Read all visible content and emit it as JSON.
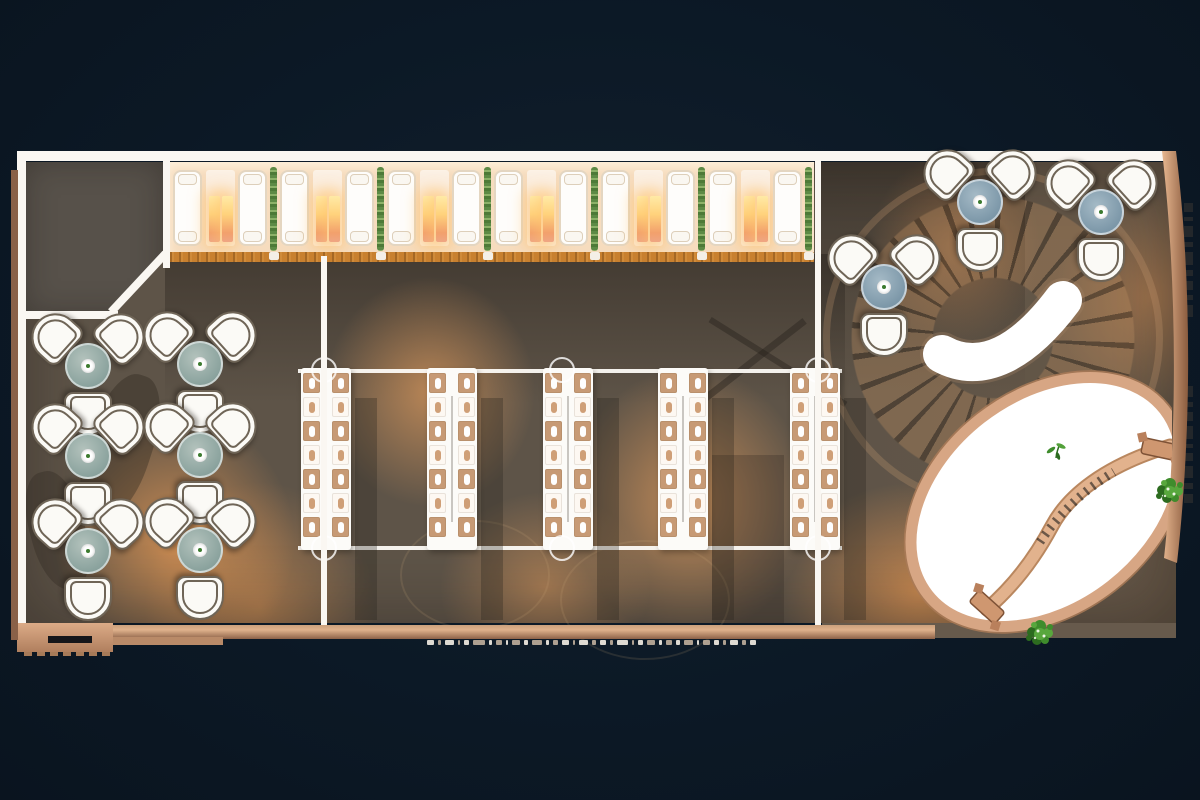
{
  "scene": {
    "title": "restaurant-lounge-floor-plan-top-view",
    "palette": {
      "background_navy": "#0c1926",
      "floor_olive": "#5e5448",
      "warm_light": "#e89854",
      "room_dark": "#57514a",
      "wall_white": "#faf7f2",
      "booth_band": "#f6dcbe",
      "sofa_white": "#fefdfb",
      "lamp_glow": "#ffd27c",
      "plant_green": "#5d8a45",
      "wood_strip": "#c8802f",
      "seat_tan": "#c79a75",
      "seat_cream": "#fdf8f2",
      "cluster_table_left": "#8ba39e",
      "cluster_table_right": "#7d98a9",
      "chair_outline": "#6f6557",
      "stair_copper": "#ba8c60",
      "terrace_white": "#ffffff",
      "copper_rim": "#d7a684",
      "path_copper": "#e2b28d",
      "bush_green": "#3f8c2c",
      "trim_copper": "#caa07c"
    },
    "booth_row": {
      "y": 162,
      "height": 90,
      "module_width": 107,
      "module_starts_x": [
        170,
        277,
        384,
        491,
        598,
        705
      ],
      "sofa1_dx": 3,
      "lamp_dx": 36,
      "sofa2_dx": 68,
      "plant_dx": 100,
      "flame_dx": [
        3,
        16
      ]
    },
    "wood_strip": {
      "x": 170,
      "y": 252,
      "width": 644,
      "notch_dx": 99
    },
    "communal_tables": {
      "tables_x": [
        301,
        427,
        543,
        658,
        790
      ],
      "y": 368,
      "width": 50,
      "height": 182,
      "seats_per_column": 7,
      "columns_dx": [
        2,
        31
      ],
      "seat_pitch": 24,
      "seat_top": 5
    },
    "light_rails": {
      "x": 298,
      "width": 544,
      "rows_y": [
        369,
        546
      ],
      "fixtures_x": [
        324,
        562,
        818
      ],
      "fixture_rows_y": [
        370,
        548
      ]
    },
    "walls": {
      "segments": [
        {
          "name": "wall-top",
          "x": 17,
          "y": 151,
          "w": 1159,
          "h": 10
        },
        {
          "name": "wall-left",
          "x": 17,
          "y": 151,
          "w": 9,
          "h": 474
        },
        {
          "name": "wall-divider-right",
          "x": 815,
          "y": 161,
          "w": 6,
          "h": 465
        },
        {
          "name": "wall-center-line",
          "x": 321,
          "y": 256,
          "w": 6,
          "h": 370
        },
        {
          "name": "wall-room-right",
          "x": 163,
          "y": 161,
          "w": 7,
          "h": 107
        },
        {
          "name": "wall-room-bottom",
          "x": 25,
          "y": 311,
          "w": 93,
          "h": 8
        }
      ],
      "diagonal": {
        "x": 111,
        "y": 308,
        "len": 80,
        "h": 8,
        "angle": -47
      }
    },
    "lounge_clusters": {
      "chairs_per_cluster": 3,
      "left_centers": [
        [
          88,
          372
        ],
        [
          200,
          370
        ],
        [
          88,
          462
        ],
        [
          200,
          461
        ],
        [
          88,
          557
        ],
        [
          200,
          556
        ]
      ],
      "right_centers": [
        [
          884,
          293
        ],
        [
          980,
          208
        ],
        [
          1101,
          218
        ]
      ]
    },
    "staircase": {
      "cx": 993,
      "cy": 338,
      "outer_diameter": 290,
      "landing_crescent_d": "M942,354 C982,376 1024,352 1063,300"
    },
    "terrace": {
      "cx": 1046,
      "cy": 502,
      "rx": 150,
      "ry": 106,
      "rotate": -38
    },
    "garden_path": {
      "d_main": "M987,609 C1016,584 1036,556 1052,526 C1068,496 1104,466 1170,446",
      "d_steps": "M1040,542 C1056,518 1080,492 1114,472"
    },
    "gates": [
      {
        "x": 987,
        "y": 607,
        "angle": 42
      },
      {
        "x": 1159,
        "y": 449,
        "angle": 12
      }
    ],
    "bushes": [
      {
        "x": 1040,
        "y": 634
      },
      {
        "x": 1170,
        "y": 492
      }
    ],
    "sprout": {
      "x": 1056,
      "y": 452
    },
    "right_wall_d": "M1162,151 L1176,151 C1192,280 1192,430 1177,563 L1164,558 C1178,430 1177,280 1162,151 Z",
    "perimeter_marks": {
      "left_ticks": {
        "x": 11,
        "w": 6,
        "y0": 213,
        "gap": 4,
        "heights": [
          12,
          5,
          3,
          9,
          14,
          4,
          7,
          11,
          3,
          6,
          13,
          5,
          8,
          4,
          10,
          6
        ]
      },
      "right_tick_groups": [
        {
          "x": 1184,
          "w": 9,
          "y0": 203,
          "gap": 5,
          "heights": [
            9,
            4,
            11,
            5,
            13,
            6,
            9,
            5,
            12
          ]
        },
        {
          "x": 1184,
          "w": 9,
          "y0": 386,
          "gap": 5,
          "heights": [
            11,
            5,
            9,
            13,
            4,
            8,
            12,
            6,
            9
          ]
        }
      ],
      "bottom_dashes": {
        "x0": 427,
        "gap": 4,
        "widths": [
          7,
          3,
          9,
          2,
          5,
          12,
          3,
          6,
          2,
          8,
          4,
          10,
          3,
          5,
          7,
          2,
          9,
          4,
          6,
          3,
          11,
          2,
          5,
          8,
          3,
          6,
          4,
          9,
          2,
          7,
          5,
          3,
          8,
          4,
          6
        ]
      },
      "teeth_x0": 24,
      "teeth_pitch": 13,
      "teeth_count": 7
    }
  }
}
